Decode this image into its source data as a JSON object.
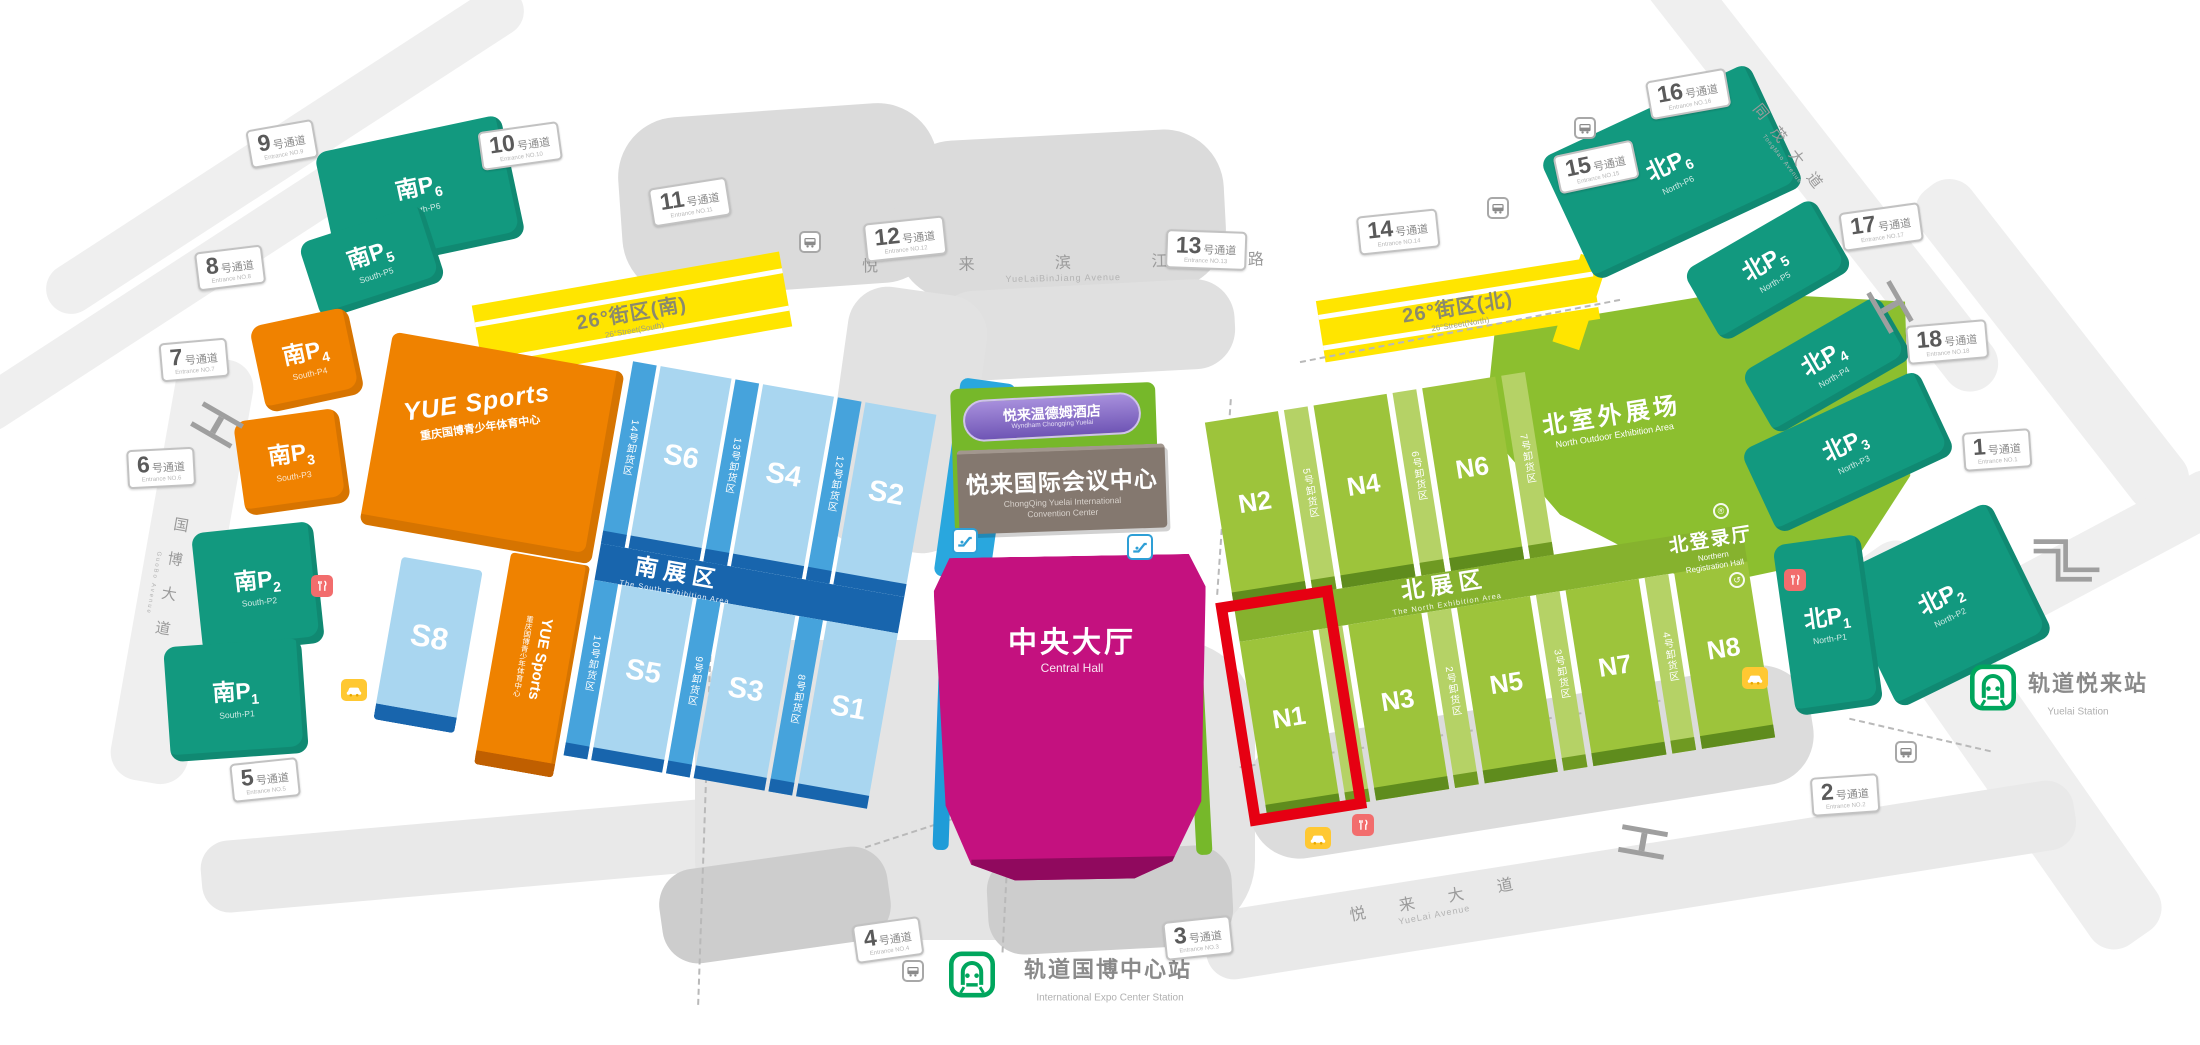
{
  "ui": {
    "passage_suffix": "号通道"
  },
  "passages": [
    {
      "num": "1",
      "en": "Entrance NO.1"
    },
    {
      "num": "2",
      "en": "Entrance NO.2"
    },
    {
      "num": "3",
      "en": "Entrance NO.3"
    },
    {
      "num": "4",
      "en": "Entrance NO.4"
    },
    {
      "num": "5",
      "en": "Entrance NO.5"
    },
    {
      "num": "6",
      "en": "Entrance NO.6"
    },
    {
      "num": "7",
      "en": "Entrance NO.7"
    },
    {
      "num": "8",
      "en": "Entrance NO.8"
    },
    {
      "num": "9",
      "en": "Entrance NO.9"
    },
    {
      "num": "10",
      "en": "Entrance NO.10"
    },
    {
      "num": "11",
      "en": "Entrance NO.11"
    },
    {
      "num": "12",
      "en": "Entrance NO.12"
    },
    {
      "num": "13",
      "en": "Entrance NO.13"
    },
    {
      "num": "14",
      "en": "Entrance NO.14"
    },
    {
      "num": "15",
      "en": "Entrance NO.15"
    },
    {
      "num": "16",
      "en": "Entrance NO.16"
    },
    {
      "num": "17",
      "en": "Entrance NO.17"
    },
    {
      "num": "18",
      "en": "Entrance NO.18"
    }
  ],
  "roads": {
    "binjiang_zh": "悦 来 滨 江 路",
    "binjiang_en": "YueLaiBinJiang Avenue",
    "guobo_zh": "国博大道",
    "guobo_en": "GuoBo Avenue",
    "tongmao_zh": "同茂大道",
    "tongmao_en": "TongMao Avenue",
    "yuelai_zh": "悦来大道",
    "yuelai_en": "YueLai Avenue"
  },
  "stations": {
    "expo_zh": "轨道国博中心站",
    "expo_en": "International Expo Center Station",
    "yuelai_zh": "轨道悦来站",
    "yuelai_en": "Yuelai Station"
  },
  "streets26": {
    "south_zh": "26°街区(南)",
    "south_en": "26°Street(South)",
    "north_zh": "26°街区(北)",
    "north_en": "26°Street(North)"
  },
  "yue_sports": {
    "title": "YUE Sports",
    "subtitle": "重庆国博青少年体育中心"
  },
  "center": {
    "hotel_zh": "悦来温德姆酒店",
    "hotel_en": "Wyndham Chongqing Yuelai",
    "conv_zh": "悦来国际会议中心",
    "conv_en1": "ChongQing Yuelai International",
    "conv_en2": "Convention Center",
    "hall_zh": "中央大厅",
    "hall_en": "Central Hall"
  },
  "south_area": {
    "name_zh": "南展区",
    "name_en": "The South Exhibition Area",
    "halls_top": [
      "S6",
      "S4",
      "S2"
    ],
    "docks_top": [
      "14号卸货区",
      "13号卸货区",
      "12号卸货区"
    ],
    "halls_bottom": [
      "S5",
      "S3",
      "S1"
    ],
    "docks_bottom": [
      "10号卸货区",
      "9号卸货区",
      "8号卸货区"
    ],
    "s8": "S8"
  },
  "north_area": {
    "name_zh": "北展区",
    "name_en": "The North Exhibition Area",
    "halls_top": [
      "N2",
      "N4",
      "N6"
    ],
    "docks_top": [
      "5号卸货区",
      "6号卸货区",
      "7号卸货区"
    ],
    "halls_bottom": [
      "N1",
      "N3",
      "N5",
      "N7",
      "N8"
    ],
    "docks_bottom": [
      "1号卸货区",
      "2号卸货区",
      "3号卸货区",
      "4号卸货区"
    ],
    "outdoor_zh": "北室外展场",
    "outdoor_en": "North Outdoor Exhibition Area",
    "reg_zh": "北登录厅",
    "reg_en1": "Northern",
    "reg_en2": "Registration Hall"
  },
  "parking": {
    "south": [
      {
        "p": "南P",
        "n": "1",
        "en": "South-P1"
      },
      {
        "p": "南P",
        "n": "2",
        "en": "South-P2"
      },
      {
        "p": "南P",
        "n": "3",
        "en": "South-P3"
      },
      {
        "p": "南P",
        "n": "4",
        "en": "South-P4"
      },
      {
        "p": "南P",
        "n": "5",
        "en": "South-P5"
      },
      {
        "p": "南P",
        "n": "6",
        "en": "South-P6"
      }
    ],
    "north": [
      {
        "p": "北P",
        "n": "1",
        "en": "North-P1"
      },
      {
        "p": "北P",
        "n": "2",
        "en": "North-P2"
      },
      {
        "p": "北P",
        "n": "3",
        "en": "North-P3"
      },
      {
        "p": "北P",
        "n": "4",
        "en": "North-P4"
      },
      {
        "p": "北P",
        "n": "5",
        "en": "North-P5"
      },
      {
        "p": "北P",
        "n": "6",
        "en": "North-P6"
      }
    ]
  },
  "highlight": {
    "hall": "N1",
    "color": "#E60012"
  },
  "icons": {
    "metro": "metro-station-icon (green train front)",
    "bus_stop": "bus-stop-icon (gray bus in white box)",
    "car": "car-icon (white car on yellow box)",
    "restaurant": "restaurant-icon (white fork and knife on red box)",
    "escalator": "escalator-icon (blue steps in white box)",
    "bridge": "footbridge-icon (gray I-beam)",
    "stairs": "stairs-icon (gray zigzag)",
    "registered": "registration-badge-icon (circled R)",
    "loop": "loop-arrow-icon (circled arrow)"
  },
  "colors": {
    "teal": "#12997F",
    "orange": "#F08200",
    "hall_blue": "#A9D6F0",
    "dock_blue": "#46A3DC",
    "deep_blue": "#1865AD",
    "hall_green": "#9DC43B",
    "area_green": "#8CBF2F",
    "magenta": "#C4117F",
    "yellow": "#FFE500",
    "highlight_red": "#E60012",
    "purple": "#8F76C9",
    "brown": "#84786F",
    "metro_green": "#00A65D"
  }
}
